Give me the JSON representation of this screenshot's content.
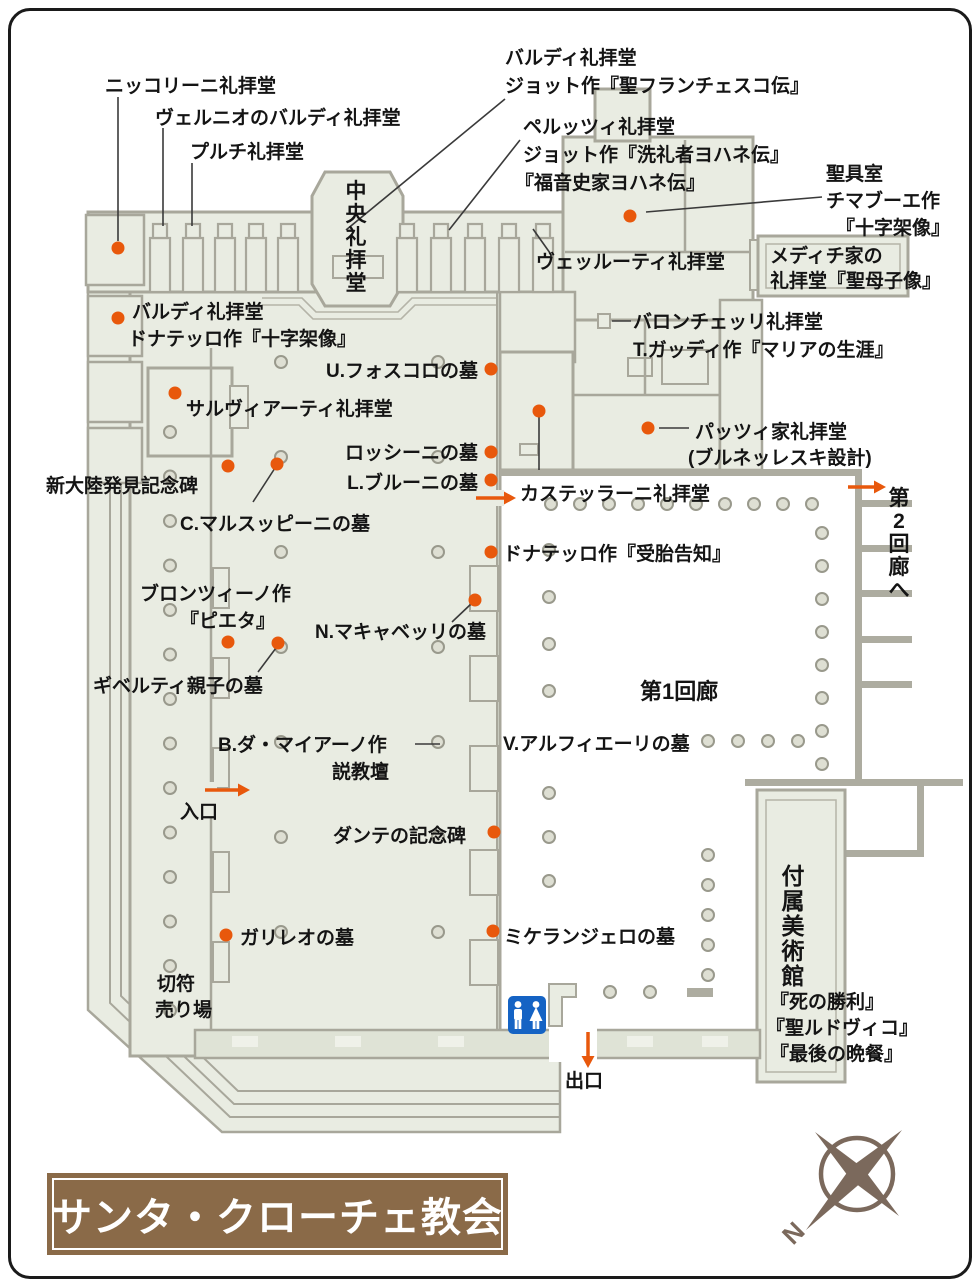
{
  "title": {
    "text": "サンタ・クローチェ教会"
  },
  "compass": {
    "north_label": "N"
  },
  "map": {
    "colors": {
      "accent": "#e8580c",
      "wall": "#a8a79b",
      "fill": "#e9ece2",
      "text": "#141414",
      "leader": "#3a3a3a",
      "column_fill": "#dedfd3",
      "column_stroke": "#99998c",
      "title_brown": "#8a6a48",
      "wc_blue": "#1563c4",
      "compass_brown": "#7b695c"
    },
    "labels": [
      {
        "name": "label-niccolini-chapel",
        "text": "ニッコリーニ礼拝堂",
        "x": 105,
        "y": 92
      },
      {
        "name": "label-bardi-vernio-chapel",
        "text": "ヴェルニオのバルディ礼拝堂",
        "x": 155,
        "y": 124
      },
      {
        "name": "label-pulci-chapel",
        "text": "プルチ礼拝堂",
        "x": 190,
        "y": 158
      },
      {
        "name": "label-bardi-giotto-chapel-line1",
        "text": "バルディ礼拝堂",
        "x": 505,
        "y": 64
      },
      {
        "name": "label-bardi-giotto-chapel-line2",
        "text": "ジョット作『聖フランチェスコ伝』",
        "x": 505,
        "y": 92
      },
      {
        "name": "label-peruzzi-chapel-line1",
        "text": "ペルッツィ礼拝堂",
        "x": 523,
        "y": 133
      },
      {
        "name": "label-peruzzi-chapel-line2",
        "text": "ジョット作『洗礼者ヨハネ伝』",
        "x": 523,
        "y": 161
      },
      {
        "name": "label-peruzzi-chapel-line3",
        "text": "『福音史家ヨハネ伝』",
        "x": 515,
        "y": 189
      },
      {
        "name": "label-sacristy-line1",
        "text": "聖具室",
        "x": 826,
        "y": 180
      },
      {
        "name": "label-sacristy-line2",
        "text": "チマブーエ作",
        "x": 826,
        "y": 207
      },
      {
        "name": "label-sacristy-line3",
        "text": "『十字架像』",
        "x": 836,
        "y": 234
      },
      {
        "name": "label-velluti-chapel",
        "text": "ヴェッルーティ礼拝堂",
        "x": 536,
        "y": 268
      },
      {
        "name": "label-medici-chapel-line1",
        "text": "メディチ家の",
        "x": 770,
        "y": 262
      },
      {
        "name": "label-medici-chapel-line2",
        "text": "礼拝堂『聖母子像』",
        "x": 770,
        "y": 287
      },
      {
        "name": "label-baroncelli-chapel-line1",
        "text": "バロンチェッリ礼拝堂",
        "x": 633,
        "y": 328
      },
      {
        "name": "label-baroncelli-chapel-line2",
        "text": "T.ガッディ作『マリアの生涯』",
        "x": 633,
        "y": 356
      },
      {
        "name": "label-bardi-donatello-line1",
        "text": "バルディ礼拝堂",
        "x": 132,
        "y": 318
      },
      {
        "name": "label-bardi-donatello-line2",
        "text": "ドナテッロ作『十字架像』",
        "x": 128,
        "y": 345
      },
      {
        "name": "label-foscolo-tomb",
        "text": "U.フォスコロの墓",
        "x": 478,
        "y": 377,
        "align": "end"
      },
      {
        "name": "label-salviati-chapel",
        "text": "サルヴィアーティ礼拝堂",
        "x": 186,
        "y": 415
      },
      {
        "name": "label-rossini-tomb",
        "text": "ロッシーニの墓",
        "x": 478,
        "y": 459,
        "align": "end"
      },
      {
        "name": "label-bruni-tomb",
        "text": "L.ブルーニの墓",
        "x": 478,
        "y": 489,
        "align": "end"
      },
      {
        "name": "label-new-world-monument",
        "text": "新大陸発見記念碑",
        "x": 46,
        "y": 492
      },
      {
        "name": "label-marsuppini-tomb",
        "text": "C.マルスッピーニの墓",
        "x": 180,
        "y": 530
      },
      {
        "name": "label-castellani-chapel",
        "text": "カステッラーニ礼拝堂",
        "x": 520,
        "y": 500
      },
      {
        "name": "label-pazzi-chapel-line1",
        "text": "パッツィ家礼拝堂",
        "x": 695,
        "y": 438
      },
      {
        "name": "label-pazzi-chapel-line2",
        "text": "(ブルネッレスキ設計)",
        "x": 688,
        "y": 464
      },
      {
        "name": "label-to-second-cloister",
        "text": "第2回廊へ",
        "x": 899,
        "y": 505,
        "vertical": true,
        "size": 21
      },
      {
        "name": "label-donatello-annunciation",
        "text": "ドナテッロ作『受胎告知』",
        "x": 503,
        "y": 560
      },
      {
        "name": "label-bronzino-line1",
        "text": "ブロンツィーノ作",
        "x": 140,
        "y": 600
      },
      {
        "name": "label-bronzino-line2",
        "text": "『ピエタ』",
        "x": 180,
        "y": 627
      },
      {
        "name": "label-machiavelli-tomb",
        "text": "N.マキャベッリの墓",
        "x": 315,
        "y": 638
      },
      {
        "name": "label-ghiberti-tomb",
        "text": "ギベルティ親子の墓",
        "x": 93,
        "y": 692
      },
      {
        "name": "label-maiano-pulpit-line1",
        "text": "B.ダ・マイアーノ作",
        "x": 218,
        "y": 751
      },
      {
        "name": "label-maiano-pulpit-line2",
        "text": "説教壇",
        "x": 332,
        "y": 778
      },
      {
        "name": "label-alfieri-tomb",
        "text": "V.アルフィエーリの墓",
        "x": 503,
        "y": 750
      },
      {
        "name": "label-first-cloister",
        "text": "第1回廊",
        "x": 640,
        "y": 699,
        "size": 22
      },
      {
        "name": "label-entrance",
        "text": "入口",
        "x": 180,
        "y": 818
      },
      {
        "name": "label-dante-monument",
        "text": "ダンテの記念碑",
        "x": 333,
        "y": 842
      },
      {
        "name": "label-galileo-tomb",
        "text": "ガリレオの墓",
        "x": 240,
        "y": 944
      },
      {
        "name": "label-michelangelo-tomb",
        "text": "ミケランジェロの墓",
        "x": 504,
        "y": 943
      },
      {
        "name": "label-ticket-office-line1",
        "text": "切符",
        "x": 157,
        "y": 990
      },
      {
        "name": "label-ticket-office-line2",
        "text": "売り場",
        "x": 155,
        "y": 1016
      },
      {
        "name": "label-exit",
        "text": "出口",
        "x": 565,
        "y": 1087
      },
      {
        "name": "label-museum",
        "text": "付属美術館",
        "x": 793,
        "y": 884,
        "vertical": true,
        "size": 23
      },
      {
        "name": "label-museum-work1",
        "text": "『死の勝利』",
        "x": 770,
        "y": 1008
      },
      {
        "name": "label-museum-work2",
        "text": "『聖ルドヴィコ』",
        "x": 766,
        "y": 1034
      },
      {
        "name": "label-museum-work3",
        "text": "『最後の晩餐』",
        "x": 770,
        "y": 1060
      },
      {
        "name": "label-central-chapel",
        "text": "中央礼拝堂",
        "x": 356,
        "y": 198,
        "vertical": true,
        "size": 21
      }
    ],
    "dots": [
      [
        118,
        248
      ],
      [
        630,
        216
      ],
      [
        118,
        318
      ],
      [
        175,
        393
      ],
      [
        491,
        369
      ],
      [
        491,
        452
      ],
      [
        491,
        480
      ],
      [
        228,
        466
      ],
      [
        277,
        464
      ],
      [
        539,
        411
      ],
      [
        648,
        428
      ],
      [
        491,
        552
      ],
      [
        228,
        642
      ],
      [
        278,
        643
      ],
      [
        475,
        600
      ],
      [
        494,
        832
      ],
      [
        226,
        935
      ],
      [
        493,
        931
      ]
    ],
    "leader_lines": [
      [
        118,
        97,
        118,
        241
      ],
      [
        163,
        128,
        163,
        226
      ],
      [
        192,
        163,
        192,
        226
      ],
      [
        505,
        99,
        346,
        230
      ],
      [
        520,
        140,
        449,
        230
      ],
      [
        646,
        212,
        822,
        197
      ],
      [
        533,
        229,
        550,
        253
      ],
      [
        612,
        321,
        631,
        321
      ],
      [
        659,
        428,
        689,
        428
      ],
      [
        539,
        417,
        539,
        470
      ],
      [
        253,
        502,
        275,
        468
      ],
      [
        258,
        672,
        276,
        648
      ],
      [
        452,
        622,
        471,
        604
      ],
      [
        415,
        744,
        440,
        744
      ]
    ],
    "arrows": [
      {
        "name": "arrow-entrance",
        "x": 205,
        "y": 790,
        "dir": "right",
        "len": 45
      },
      {
        "name": "arrow-to-cloister1",
        "x": 476,
        "y": 498,
        "dir": "right",
        "len": 40
      },
      {
        "name": "arrow-to-cloister2",
        "x": 848,
        "y": 487,
        "dir": "right",
        "len": 38
      },
      {
        "name": "arrow-exit",
        "x": 588,
        "y": 1032,
        "dir": "down",
        "len": 36
      }
    ],
    "column_rows": [
      {
        "axis": "v",
        "x": 170,
        "y": 432,
        "step": 44.5,
        "n": 14
      },
      {
        "axis": "v",
        "x": 281,
        "y": 362,
        "step": 95,
        "n": 7
      },
      {
        "axis": "v",
        "x": 438,
        "y": 362,
        "step": 95,
        "n": 7
      },
      {
        "axis": "h",
        "x": 551,
        "y": 504,
        "step": 29,
        "n": 10
      },
      {
        "axis": "v",
        "x": 549,
        "y": 550,
        "step": 47,
        "n": 4
      },
      {
        "axis": "v",
        "x": 549,
        "y": 793,
        "step": 44,
        "n": 3
      },
      {
        "axis": "v",
        "x": 822,
        "y": 533,
        "step": 33,
        "n": 8
      },
      {
        "axis": "h",
        "x": 708,
        "y": 741,
        "step": 30,
        "n": 4
      },
      {
        "axis": "v",
        "x": 708,
        "y": 855,
        "step": 30,
        "n": 5
      },
      {
        "axis": "h",
        "x": 610,
        "y": 992,
        "step": 40,
        "n": 2
      }
    ]
  }
}
